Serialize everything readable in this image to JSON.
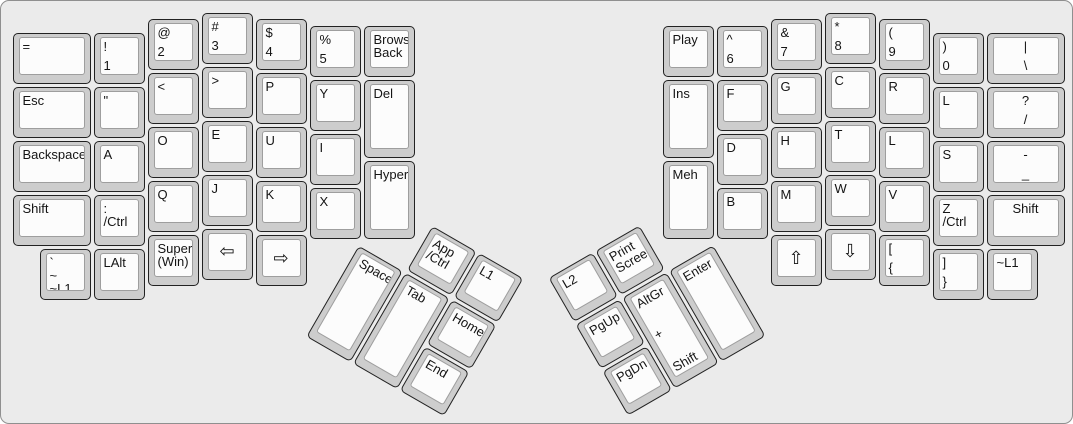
{
  "app": {
    "description": "Split ergonomic keyboard layout (ErgoDox-style), Dvorak-variant legends, two rotated thumb clusters"
  },
  "colors": {
    "board_bg": "#ebebeb",
    "board_border": "#8f8f8f",
    "key_bezel": "#cdcdcd",
    "key_face": "#fcfcfc",
    "key_border": "#0a0a0a",
    "key_text": "#141414"
  },
  "keyboard": {
    "unit_px": 54,
    "groups": [
      {
        "name": "left-main-grid",
        "origin": [
          10,
          10
        ],
        "rotation": 0,
        "pivot": [
          0,
          0
        ],
        "keys": [
          {
            "name": "equals",
            "x": 0,
            "y": 0.375,
            "w": 1.5,
            "labels": [
              "="
            ]
          },
          {
            "name": "excl-1",
            "x": 1.5,
            "y": 0.375,
            "labels": [
              "!",
              "1"
            ],
            "spread": true
          },
          {
            "name": "at-2",
            "x": 2.5,
            "y": 0.125,
            "labels": [
              "@",
              "2"
            ],
            "spread": true
          },
          {
            "name": "hash-3",
            "x": 3.5,
            "y": 0,
            "labels": [
              "#",
              "3"
            ],
            "spread": true
          },
          {
            "name": "dollar-4",
            "x": 4.5,
            "y": 0.125,
            "labels": [
              "$",
              "4"
            ],
            "spread": true
          },
          {
            "name": "percent-5",
            "x": 5.5,
            "y": 0.25,
            "labels": [
              "%",
              "5"
            ],
            "spread": true
          },
          {
            "name": "browser-back",
            "x": 6.5,
            "y": 0.25,
            "labels": [
              "Browser",
              "Back"
            ]
          },
          {
            "name": "esc",
            "x": 0,
            "y": 1.375,
            "w": 1.5,
            "labels": [
              "Esc"
            ]
          },
          {
            "name": "quote",
            "x": 1.5,
            "y": 1.375,
            "labels": [
              "\""
            ]
          },
          {
            "name": "less-than",
            "x": 2.5,
            "y": 1.125,
            "labels": [
              "<"
            ]
          },
          {
            "name": "greater-than",
            "x": 3.5,
            "y": 1,
            "labels": [
              ">"
            ]
          },
          {
            "name": "p",
            "x": 4.5,
            "y": 1.125,
            "labels": [
              "P"
            ]
          },
          {
            "name": "y",
            "x": 5.5,
            "y": 1.25,
            "labels": [
              "Y"
            ]
          },
          {
            "name": "del",
            "x": 6.5,
            "y": 1.25,
            "h": 1.5,
            "labels": [
              "Del"
            ]
          },
          {
            "name": "backspace",
            "x": 0,
            "y": 2.375,
            "w": 1.5,
            "labels": [
              "Backspace"
            ]
          },
          {
            "name": "a",
            "x": 1.5,
            "y": 2.375,
            "labels": [
              "A"
            ]
          },
          {
            "name": "o",
            "x": 2.5,
            "y": 2.125,
            "labels": [
              "O"
            ]
          },
          {
            "name": "e",
            "x": 3.5,
            "y": 2,
            "labels": [
              "E"
            ]
          },
          {
            "name": "u",
            "x": 4.5,
            "y": 2.125,
            "labels": [
              "U"
            ]
          },
          {
            "name": "i",
            "x": 5.5,
            "y": 2.25,
            "labels": [
              "I"
            ]
          },
          {
            "name": "hyper",
            "x": 6.5,
            "y": 2.75,
            "h": 1.5,
            "labels": [
              "Hyper"
            ]
          },
          {
            "name": "shift-left",
            "x": 0,
            "y": 3.375,
            "w": 1.5,
            "labels": [
              "Shift"
            ]
          },
          {
            "name": "colon-ctrl",
            "x": 1.5,
            "y": 3.375,
            "labels": [
              ":",
              "/Ctrl"
            ]
          },
          {
            "name": "q",
            "x": 2.5,
            "y": 3.125,
            "labels": [
              "Q"
            ]
          },
          {
            "name": "j",
            "x": 3.5,
            "y": 3,
            "labels": [
              "J"
            ]
          },
          {
            "name": "k",
            "x": 4.5,
            "y": 3.125,
            "labels": [
              "K"
            ]
          },
          {
            "name": "x",
            "x": 5.5,
            "y": 3.25,
            "labels": [
              "X"
            ]
          },
          {
            "name": "grave-tilde-l1",
            "x": 0.5,
            "y": 4.375,
            "labels": [
              "`",
              "~",
              "~L1"
            ],
            "spread": true
          },
          {
            "name": "lalt",
            "x": 1.5,
            "y": 4.375,
            "labels": [
              "LAlt"
            ]
          },
          {
            "name": "super-win",
            "x": 2.5,
            "y": 4.125,
            "labels": [
              "Super",
              "(Win)"
            ]
          },
          {
            "name": "arrow-left",
            "x": 3.5,
            "y": 4,
            "labels": [
              "⇦"
            ],
            "big": true
          },
          {
            "name": "arrow-right",
            "x": 4.5,
            "y": 4.125,
            "labels": [
              "⇨"
            ],
            "big": true
          }
        ]
      },
      {
        "name": "right-main-grid",
        "origin": [
          660,
          10
        ],
        "rotation": 0,
        "pivot": [
          0,
          0
        ],
        "keys": [
          {
            "name": "play",
            "x": 0,
            "y": 0.25,
            "labels": [
              "Play"
            ]
          },
          {
            "name": "caret-6",
            "x": 1,
            "y": 0.25,
            "labels": [
              "^",
              "6"
            ],
            "spread": true
          },
          {
            "name": "amp-7",
            "x": 2,
            "y": 0.125,
            "labels": [
              "&",
              "7"
            ],
            "spread": true
          },
          {
            "name": "asterisk-8",
            "x": 3,
            "y": 0,
            "labels": [
              "*",
              "8"
            ],
            "spread": true
          },
          {
            "name": "lparen-9",
            "x": 4,
            "y": 0.125,
            "labels": [
              "(",
              "9"
            ],
            "spread": true
          },
          {
            "name": "rparen-0",
            "x": 5,
            "y": 0.375,
            "labels": [
              ")",
              "0"
            ],
            "spread": true
          },
          {
            "name": "pipe-backslash",
            "x": 6,
            "y": 0.375,
            "w": 1.5,
            "labels": [
              "|",
              "\\"
            ],
            "spread": true,
            "center": true
          },
          {
            "name": "ins",
            "x": 0,
            "y": 1.25,
            "h": 1.5,
            "labels": [
              "Ins"
            ]
          },
          {
            "name": "f",
            "x": 1,
            "y": 1.25,
            "labels": [
              "F"
            ]
          },
          {
            "name": "g",
            "x": 2,
            "y": 1.125,
            "labels": [
              "G"
            ]
          },
          {
            "name": "c",
            "x": 3,
            "y": 1,
            "labels": [
              "C"
            ]
          },
          {
            "name": "r",
            "x": 4,
            "y": 1.125,
            "labels": [
              "R"
            ]
          },
          {
            "name": "l-top-row",
            "x": 5,
            "y": 1.375,
            "labels": [
              "L"
            ]
          },
          {
            "name": "question-slash",
            "x": 6,
            "y": 1.375,
            "w": 1.5,
            "labels": [
              "?",
              "/"
            ],
            "spread": true,
            "center": true
          },
          {
            "name": "meh",
            "x": 0,
            "y": 2.75,
            "h": 1.5,
            "labels": [
              "Meh"
            ]
          },
          {
            "name": "d",
            "x": 1,
            "y": 2.25,
            "labels": [
              "D"
            ]
          },
          {
            "name": "h",
            "x": 2,
            "y": 2.125,
            "labels": [
              "H"
            ]
          },
          {
            "name": "t",
            "x": 3,
            "y": 2,
            "labels": [
              "T"
            ]
          },
          {
            "name": "l-home-row",
            "x": 4,
            "y": 2.125,
            "labels": [
              "L"
            ]
          },
          {
            "name": "s",
            "x": 5,
            "y": 2.375,
            "labels": [
              "S"
            ]
          },
          {
            "name": "dash-underscore",
            "x": 6,
            "y": 2.375,
            "w": 1.5,
            "labels": [
              "-",
              "_"
            ],
            "spread": true,
            "center": true
          },
          {
            "name": "b",
            "x": 1,
            "y": 3.25,
            "labels": [
              "B"
            ]
          },
          {
            "name": "m",
            "x": 2,
            "y": 3.125,
            "labels": [
              "M"
            ]
          },
          {
            "name": "w",
            "x": 3,
            "y": 3,
            "labels": [
              "W"
            ]
          },
          {
            "name": "v",
            "x": 4,
            "y": 3.125,
            "labels": [
              "V"
            ]
          },
          {
            "name": "z-ctrl",
            "x": 5,
            "y": 3.375,
            "labels": [
              "Z",
              "/Ctrl"
            ]
          },
          {
            "name": "shift-right",
            "x": 6,
            "y": 3.375,
            "w": 1.5,
            "labels": [
              "Shift"
            ],
            "center": true
          },
          {
            "name": "arrow-up",
            "x": 2,
            "y": 4.125,
            "labels": [
              "⇧"
            ],
            "big": true
          },
          {
            "name": "arrow-down",
            "x": 3,
            "y": 4,
            "labels": [
              "⇩"
            ],
            "big": true
          },
          {
            "name": "lbracket-lbrace",
            "x": 4,
            "y": 4.125,
            "labels": [
              "[",
              "{"
            ],
            "spread": true
          },
          {
            "name": "rbracket-rbrace",
            "x": 5,
            "y": 4.375,
            "labels": [
              "]",
              "}"
            ],
            "spread": true
          },
          {
            "name": "tilde-l1",
            "x": 6,
            "y": 4.375,
            "labels": [
              "~L1"
            ]
          }
        ]
      },
      {
        "name": "left-thumb-cluster",
        "origin": [
          357,
          188
        ],
        "rotation": 30,
        "pivot": [
          0,
          54
        ],
        "keys": [
          {
            "name": "app-ctrl",
            "x": 1,
            "y": 0,
            "labels": [
              "App",
              "/Ctrl"
            ]
          },
          {
            "name": "l1",
            "x": 2,
            "y": 0,
            "labels": [
              "L1"
            ]
          },
          {
            "name": "space",
            "x": 0,
            "y": 1,
            "h": 2,
            "labels": [
              "Space"
            ]
          },
          {
            "name": "tab",
            "x": 1,
            "y": 1,
            "h": 2,
            "labels": [
              "Tab"
            ]
          },
          {
            "name": "home",
            "x": 2,
            "y": 1,
            "labels": [
              "Home"
            ]
          },
          {
            "name": "end",
            "x": 2,
            "y": 2,
            "labels": [
              "End"
            ]
          }
        ]
      },
      {
        "name": "right-thumb-cluster",
        "origin": [
          550,
          188
        ],
        "rotation": -30,
        "pivot": [
          162,
          54
        ],
        "keys": [
          {
            "name": "l2",
            "x": 0,
            "y": 0,
            "labels": [
              "L2"
            ]
          },
          {
            "name": "print-screen",
            "x": 1,
            "y": 0,
            "labels": [
              "Print",
              "Screen"
            ]
          },
          {
            "name": "pgup",
            "x": 0,
            "y": 1,
            "labels": [
              "PgUp"
            ]
          },
          {
            "name": "altgr-plus-shift",
            "x": 1,
            "y": 1,
            "h": 2,
            "labels": [
              "AltGr",
              "+",
              "Shift"
            ],
            "spread": true
          },
          {
            "name": "enter",
            "x": 2,
            "y": 1,
            "h": 2,
            "labels": [
              "Enter"
            ]
          },
          {
            "name": "pgdn",
            "x": 0,
            "y": 2,
            "labels": [
              "PgDn"
            ]
          }
        ]
      }
    ]
  }
}
